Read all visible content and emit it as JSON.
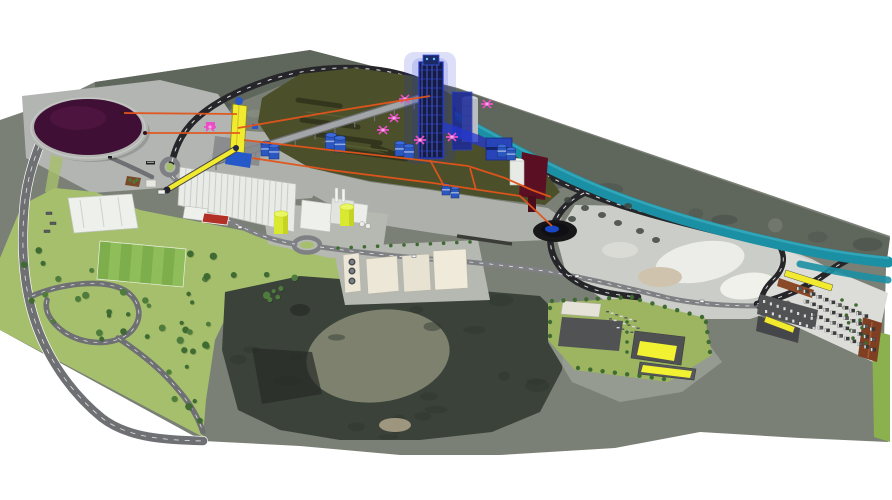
{
  "meta": {
    "title": "3D aerial masterplan render of a cement plant site over satellite imagery",
    "canvas": {
      "width": 892,
      "height": 500
    }
  },
  "palette": {
    "white_bg": "#ffffff",
    "terrain_base": "#7b8076",
    "terrain_band": "#5f665c",
    "mottle_dark": "#49504a",
    "mottle_light": "#8a9084",
    "forest": "#3b423a",
    "forest_clearing": "#7d816e",
    "park_green": "#a6bf6c",
    "complex_green": "#9db461",
    "bright_green": "#8ab14e",
    "field_light": "#8fbd5a",
    "field_dark": "#7ead4c",
    "tree_green": "#3f6b33",
    "dome_purple": "#400f35",
    "dome_rim": "#c3c6c2",
    "pad_gray": "#b2b5b1",
    "apron_gray": "#aeb1ab",
    "road_black": "#26262a",
    "road_gray": "#7e8083",
    "road_white": "#f2f2f0",
    "highway_gray": "#6e7073",
    "platform_olive": "#4b4f2a",
    "platform_row": "#31341b",
    "river_teal": "#1b8fa3",
    "river_light": "#35a8ba",
    "orange_conveyor": "#e2541b",
    "conveyor_yellow": "#f2ea2e",
    "silo_yellow": "#d9e92f",
    "silo_yellow_light": "#eaf765",
    "blue_dark": "#141c46",
    "blue_main": "#2438d0",
    "blue_light": "#5a6ae8",
    "blue_tank": "#2a57c0",
    "pink_crane": "#e94fc6",
    "maroon_bridge": "#5a1022",
    "white_building": "#eef0ec",
    "cream_building": "#ece7d6",
    "warehouse_white": "#e9ebe7",
    "warehouse_rib": "#c9ccc8",
    "quarry_light": "#cbcdc8",
    "quarry_white": "#ecede9",
    "quarry_beige": "#cfc3ae",
    "quarry_tail": "#9aa096",
    "parking_pad": "#dcddd8",
    "lot_dark": "#515254",
    "truck_dark": "#3a3b3d",
    "brown_building": "#8a4a28",
    "brown_building2": "#7e3f22",
    "pond_dark": "#17171a",
    "pond_blue": "#1b4fd8",
    "court_red": "#b23026",
    "planter_brown": "#7a4a28",
    "wall_dark": "#3a3c38",
    "gray_silo": "#b9bcc0"
  },
  "scene": {
    "description": "Perspective 3D visualization of an industrial cement plant masterplan placed on aerial satellite terrain",
    "counts": {
      "park_trees": 52,
      "band_mottles": 18,
      "forest_mottles": 22,
      "truck_rows": 4,
      "trucks_per_row": 11,
      "warehouse_ribs": 18,
      "field_stripes": 8
    },
    "elements": [
      {
        "id": "raw-material-dome",
        "label": "circular raw material storage dome (dark purple)"
      },
      {
        "id": "preheater-tower",
        "label": "tall blue preheater tower with glow"
      },
      {
        "id": "conveyor-gallery",
        "label": "inclined conveyor gallery from crusher to tower"
      },
      {
        "id": "crusher-elevator",
        "label": "yellow crusher elevator tower"
      },
      {
        "id": "overland-conveyors",
        "label": "orange conveyor routing lines"
      },
      {
        "id": "yellow-truck-conveyor",
        "label": "yellow loading conveyor near gate"
      },
      {
        "id": "river-channel",
        "label": "teal river / water channel"
      },
      {
        "id": "river-bridge",
        "label": "maroon conveyor bridge over channel"
      },
      {
        "id": "storage-platform",
        "label": "dark olive raw material storage platform"
      },
      {
        "id": "long-warehouse",
        "label": "long white ribbed warehouse"
      },
      {
        "id": "mill-buildings",
        "label": "white cement mill buildings with stacks"
      },
      {
        "id": "yellow-silos",
        "label": "two yellow-green cement silos"
      },
      {
        "id": "cream-warehouses",
        "label": "cream packing warehouses with tank station"
      },
      {
        "id": "thickener-pond",
        "label": "dark circular thickener pond with blue water"
      },
      {
        "id": "quarry",
        "label": "light gray quarry excavation area"
      },
      {
        "id": "quarry-loop-road",
        "label": "black dashed haul road loop"
      },
      {
        "id": "highway",
        "label": "highway with teardrop interchange"
      },
      {
        "id": "roundabouts",
        "label": "two road roundabouts"
      },
      {
        "id": "office-parking",
        "label": "light parking lot with office building"
      },
      {
        "id": "football-field",
        "label": "striped football pitch"
      },
      {
        "id": "tennis-court",
        "label": "red sports court"
      },
      {
        "id": "park-trees",
        "label": "landscaped park with scattered trees"
      },
      {
        "id": "forest",
        "label": "dark forest satellite area with clearing"
      },
      {
        "id": "logistics-complex",
        "label": "logistics complex with yellow-roof warehouses"
      },
      {
        "id": "truck-terminal",
        "label": "truck parking terminal with rows of trucks"
      },
      {
        "id": "pink-cranes",
        "label": "magenta crane markers"
      }
    ]
  }
}
